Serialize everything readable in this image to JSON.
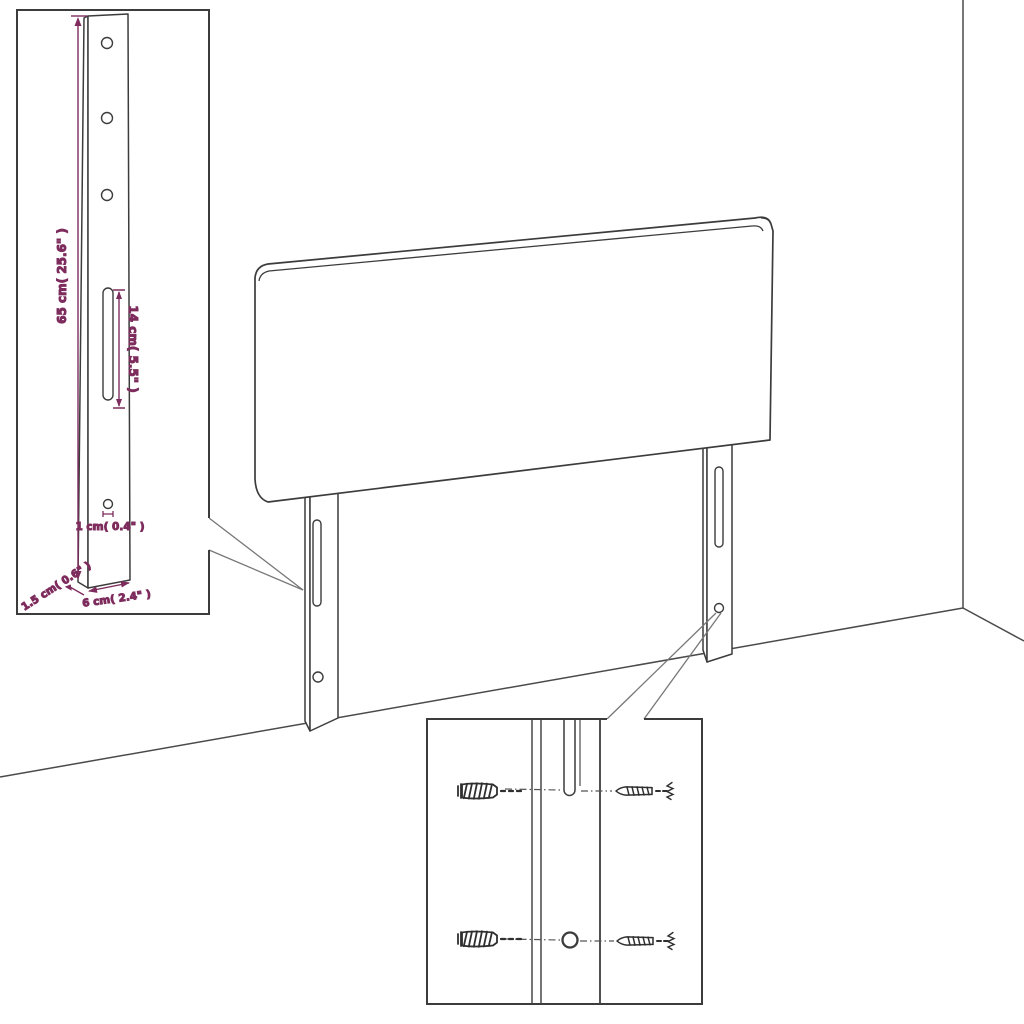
{
  "diagram": {
    "colors": {
      "line": "#3c3c3c",
      "dimension": "#7d2c5d",
      "callout": "#777777",
      "hardware": "#2f2f2f",
      "background": "#ffffff"
    },
    "leg_detail_inset": {
      "labels": {
        "height": "65 cm( 25.6\" )",
        "slot_length": "14 cm( 5.5\" )",
        "hole_diameter": "1 cm( 0.4\" )",
        "depth": "1.5 cm( 0.6\" )",
        "width": "6 cm( 2.4\" )"
      }
    },
    "hardware_inset": {
      "parts": [
        "wall-plug-icon",
        "screw-icon",
        "wall-plug-icon",
        "screw-icon"
      ]
    }
  }
}
